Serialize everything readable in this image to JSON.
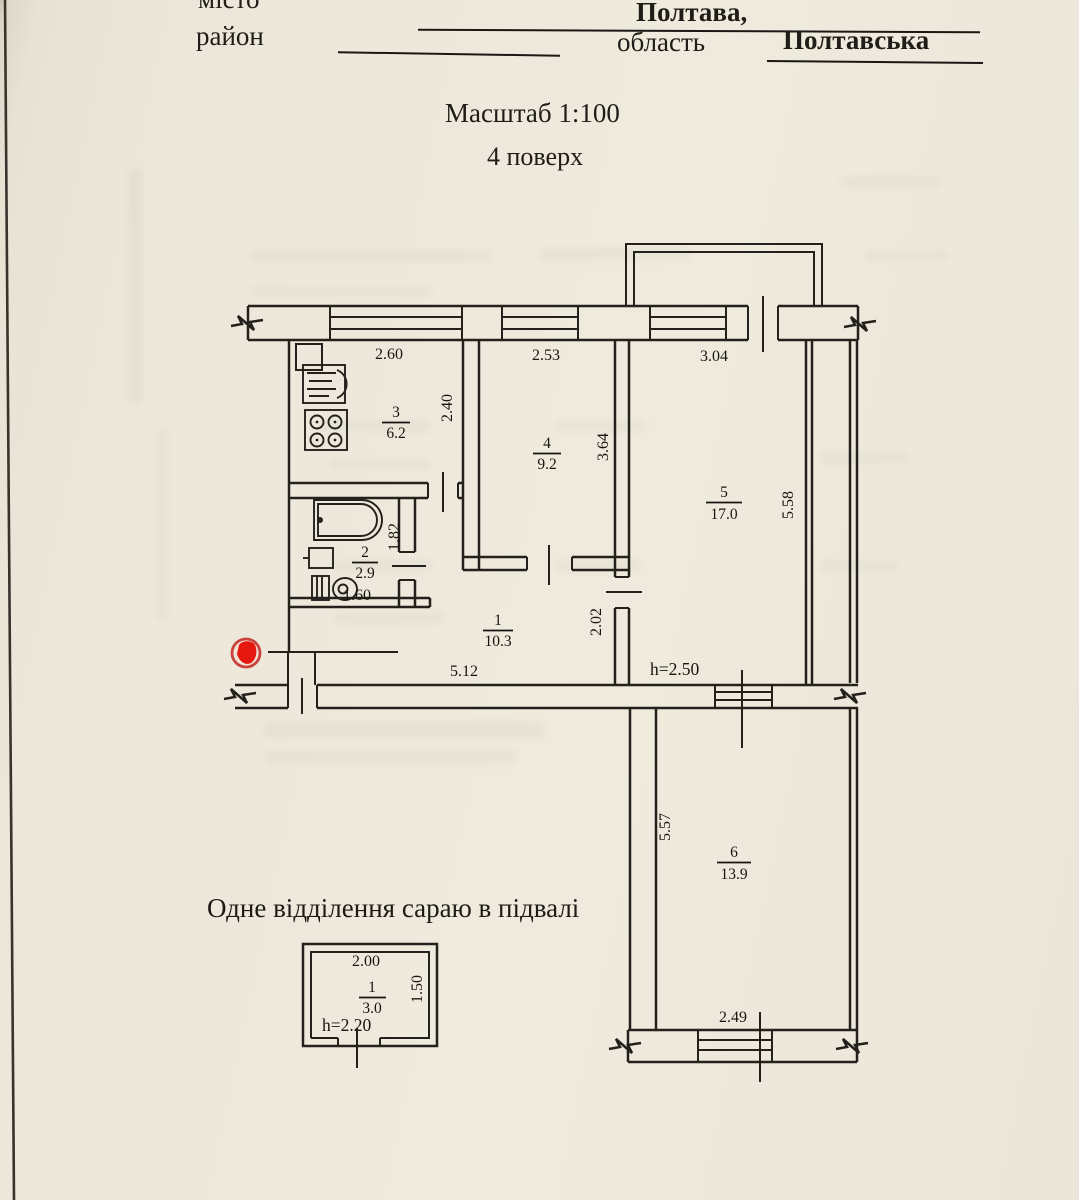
{
  "header": {
    "field_city_label": "місто",
    "field_district_label": "район",
    "city_value": "Полтава,",
    "region_label": "область",
    "region_value": "Полтавська"
  },
  "titles": {
    "scale_title": "Масштаб 1:100",
    "floor_title": "4 поверх",
    "basement_caption": "Одне відділення сараю в підвалі"
  },
  "floor_plan": {
    "ceiling_height_note": "h=2.50",
    "rooms": [
      {
        "number": "1",
        "area": "10.3"
      },
      {
        "number": "2",
        "area": "2.9"
      },
      {
        "number": "3",
        "area": "6.2"
      },
      {
        "number": "4",
        "area": "9.2"
      },
      {
        "number": "5",
        "area": "17.0"
      },
      {
        "number": "6",
        "area": "13.9"
      }
    ],
    "dimensions": {
      "kitchen_width": "2.60",
      "kitchen_depth": "2.40",
      "room4_width": "2.53",
      "room4_depth": "3.64",
      "room5_width": "3.04",
      "room5_depth": "5.58",
      "bathroom_width": "1.60",
      "bathroom_depth": "1.82",
      "hallway_length": "5.12",
      "hallway_width": "2.02",
      "room6_width": "2.49",
      "room6_depth": "5.57"
    }
  },
  "basement_plan": {
    "room_number": "1",
    "room_area": "3.0",
    "width": "2.00",
    "depth": "1.50",
    "ceiling_height_note": "h=2.20"
  },
  "colors": {
    "paper": "#ece7db",
    "ink": "#24211c",
    "marker_red": "#e6170e",
    "marker_ring": "#c9423c"
  }
}
